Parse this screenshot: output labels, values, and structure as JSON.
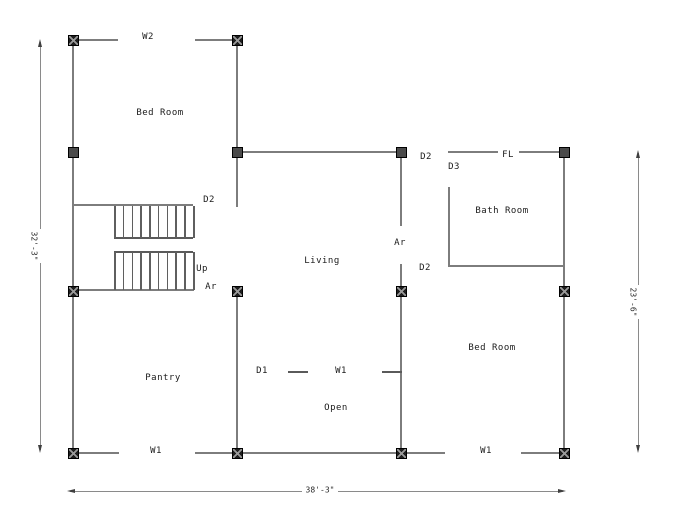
{
  "plan": {
    "type": "architectural-floor-plan",
    "colors": {
      "background": "#ffffff",
      "wall": "#7d7d7d",
      "stair_line": "#5a5a5a",
      "column_fill": "#1e1e1e",
      "column_solid_fill": "#4a4a4a",
      "text": "#1b1b1b",
      "dimension": "#8a8a8a"
    },
    "rooms": [
      {
        "name": "Bed Room",
        "x": 160,
        "y": 113
      },
      {
        "name": "Living",
        "x": 322,
        "y": 261
      },
      {
        "name": "Bath Room",
        "x": 502,
        "y": 211
      },
      {
        "name": "Pantry",
        "x": 163,
        "y": 378
      },
      {
        "name": "Open",
        "x": 336,
        "y": 408
      },
      {
        "name": "Bed Room",
        "x": 492,
        "y": 348
      }
    ],
    "openings": [
      {
        "label": "W2",
        "x": 148,
        "y": 37
      },
      {
        "label": "D2",
        "x": 209,
        "y": 200
      },
      {
        "label": "Up",
        "x": 202,
        "y": 269
      },
      {
        "label": "Ar",
        "x": 211,
        "y": 287
      },
      {
        "label": "D2",
        "x": 426,
        "y": 157
      },
      {
        "label": "D3",
        "x": 454,
        "y": 167
      },
      {
        "label": "FL",
        "x": 508,
        "y": 155
      },
      {
        "label": "Ar",
        "x": 400,
        "y": 243
      },
      {
        "label": "D2",
        "x": 425,
        "y": 268
      },
      {
        "label": "D1",
        "x": 262,
        "y": 371
      },
      {
        "label": "W1",
        "x": 341,
        "y": 371
      },
      {
        "label": "W1",
        "x": 156,
        "y": 451
      },
      {
        "label": "W1",
        "x": 486,
        "y": 451
      }
    ],
    "dimensions": [
      {
        "id": "left",
        "label": "32'-3\"",
        "orientation": "vertical",
        "x": 40,
        "y1": 40,
        "y2": 452,
        "tx": 34,
        "ty": 246
      },
      {
        "id": "right",
        "label": "23'-6\"",
        "orientation": "vertical",
        "x": 638,
        "y1": 151,
        "y2": 452,
        "tx": 633,
        "ty": 302
      },
      {
        "id": "bottom",
        "label": "38'-3\"",
        "orientation": "horizontal",
        "y": 491,
        "x1": 68,
        "x2": 565,
        "tx": 320,
        "ty": 490
      }
    ],
    "geometry": {
      "walls": [
        [
          72,
          39,
          2,
          415
        ],
        [
          78,
          39,
          40,
          2
        ],
        [
          195,
          39,
          43,
          2
        ],
        [
          236,
          39,
          2,
          114
        ],
        [
          242,
          151,
          160,
          2
        ],
        [
          236,
          151,
          2,
          56
        ],
        [
          448,
          151,
          50,
          2
        ],
        [
          519,
          151,
          46,
          2
        ],
        [
          563,
          151,
          2,
          303
        ],
        [
          400,
          158,
          2,
          68
        ],
        [
          400,
          264,
          2,
          22
        ],
        [
          400,
          297,
          2,
          151
        ],
        [
          448,
          187,
          2,
          80
        ],
        [
          448,
          265,
          117,
          2
        ],
        [
          236,
          297,
          2,
          151
        ],
        [
          72,
          204,
          121,
          2
        ],
        [
          78,
          289,
          116,
          2
        ],
        [
          78,
          452,
          41,
          2
        ],
        [
          195,
          452,
          43,
          2
        ],
        [
          242,
          452,
          160,
          2
        ],
        [
          406,
          452,
          39,
          2
        ],
        [
          521,
          452,
          44,
          2
        ]
      ],
      "thin_lines": [
        [
          114,
          237,
          79,
          1.5
        ],
        [
          114,
          251,
          79,
          1.5
        ],
        [
          288,
          371,
          20,
          1.5
        ],
        [
          382,
          371,
          20,
          1.5
        ]
      ],
      "stairs": {
        "x1": 114,
        "x2": 193,
        "tread_count": 10,
        "flight1_y": 206,
        "flight1_h": 32,
        "flight2_y": 252,
        "flight2_h": 38
      },
      "columns_x": [
        [
          73,
          40
        ],
        [
          237,
          40
        ],
        [
          73,
          291
        ],
        [
          237,
          291
        ],
        [
          401,
          291
        ],
        [
          564,
          291
        ],
        [
          73,
          453
        ],
        [
          237,
          453
        ],
        [
          401,
          453
        ],
        [
          564,
          453
        ]
      ],
      "columns_solid": [
        [
          73,
          152
        ],
        [
          237,
          152
        ],
        [
          401,
          152
        ],
        [
          564,
          152
        ]
      ]
    }
  }
}
